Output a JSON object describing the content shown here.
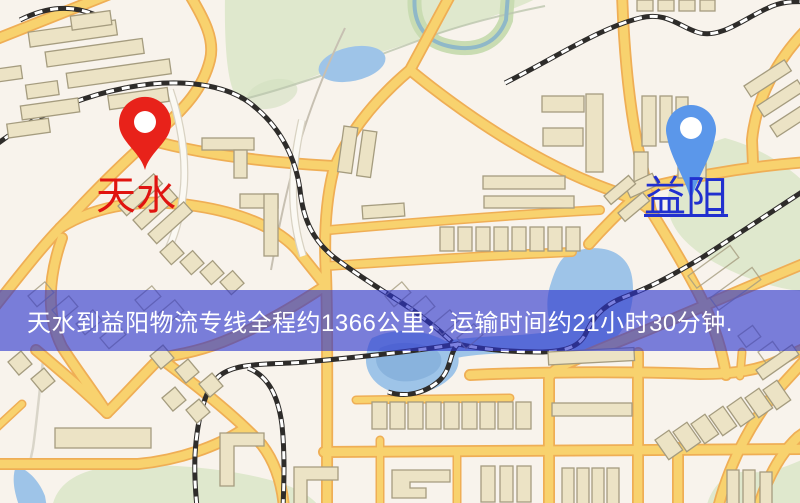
{
  "banner": {
    "text": "天水到益阳物流专线全程约1366公里，运输时间约21小时30分钟."
  },
  "route": {
    "origin": "天水",
    "destination": "益阳",
    "service": "物流专线",
    "distance_text": "约1366公里",
    "duration_text": "约21小时30分钟"
  },
  "markers": {
    "origin": {
      "name": "天水",
      "pin": "red-map-pin",
      "underlined": false
    },
    "destination": {
      "name": "益阳",
      "pin": "blue-map-pin",
      "underlined": true
    }
  },
  "theme": {
    "map-bg": "#f8f3ec",
    "park": "#dfe8cd",
    "park-deep": "#d2dfc0",
    "water": "#9ec4e8",
    "water-deep": "#82add9",
    "road": "#f8d26e",
    "road-casing": "#efae55",
    "building": "#ece3c5",
    "building-stroke": "#a59c7f",
    "rail-dark": "#2e2c2a",
    "rail-light": "#ffffff",
    "banner-bg": "rgba(43,51,205,0.62)",
    "banner-text": "#ffffff",
    "pin-origin": "#e8221a",
    "pin-destination": "#5b97ea",
    "label-origin": "#e01410",
    "label-destination": "#2130cf"
  }
}
